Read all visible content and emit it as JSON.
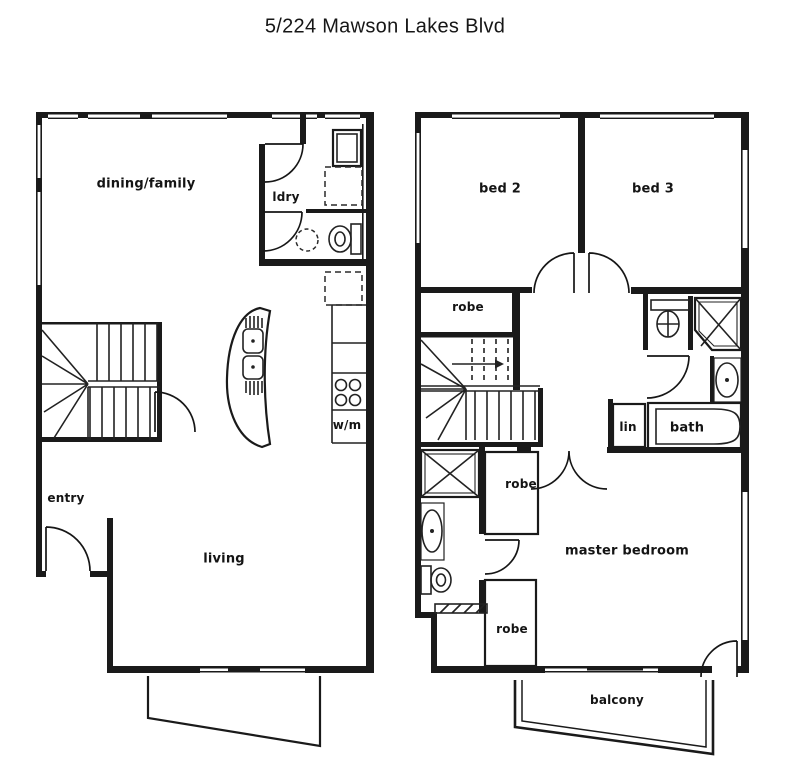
{
  "title": "5/224 Mawson Lakes Blvd",
  "ground_floor": {
    "rooms": {
      "dining_family": "dining/family",
      "laundry": "ldry",
      "washing_machine": "w/m",
      "entry": "entry",
      "living": "living"
    }
  },
  "upper_floor": {
    "rooms": {
      "bed2": "bed 2",
      "bed3": "bed 3",
      "robe_bed2": "robe",
      "robe_hall": "robe",
      "robe_master": "robe",
      "linen": "lin",
      "bath": "bath",
      "master_bedroom": "master bedroom",
      "balcony": "balcony"
    }
  },
  "colors": {
    "ink": "#1a1a1a",
    "paper": "#ffffff"
  }
}
